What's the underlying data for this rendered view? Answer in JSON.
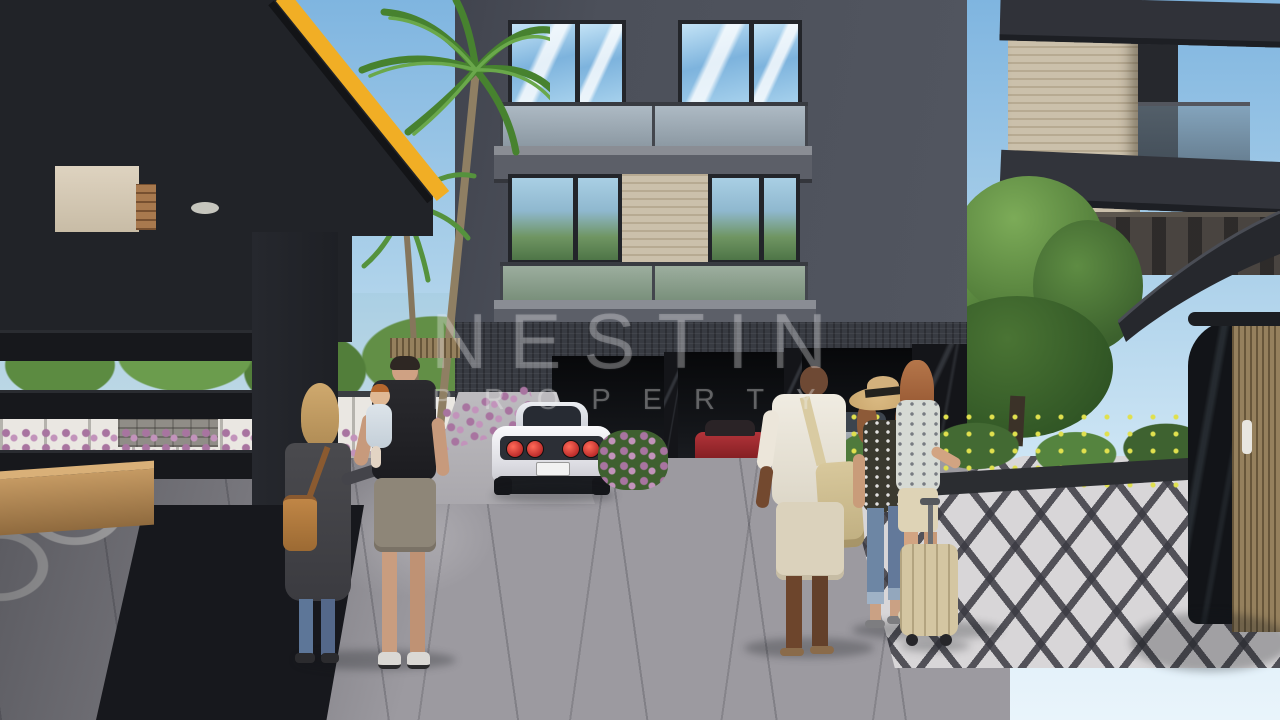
{
  "watermark": {
    "line1": "NESTIN",
    "line2": "PROPERTY"
  },
  "palette": {
    "sky_top": "#7fb5e0",
    "sky_bottom": "#e9f4fb",
    "building_wall": "#4c505a",
    "accent_yellow": "#f1ae25",
    "canopy_dark": "#212328",
    "travertine": "#cbc0ab",
    "garage_stone": "#383b42",
    "pavement_gray": "#a8a6ab",
    "pavement_ring_white": "#e7e5e4",
    "foliage_green": "#5c8b41",
    "flower_purple": "#a874a0",
    "flower_yellow": "#e0e04e",
    "sports_car_white": "#f2f2f5",
    "taillight_red": "#c02020"
  },
  "scene": {
    "setting": "3D architectural exterior render of a modern dark apartment complex entrance with residents",
    "elements": [
      "dark entrance canopy with yellow trim",
      "palm trees",
      "apartment facade with glass balconies and travertine panel",
      "garage level with white sports car and parked cars",
      "family with toddler",
      "three residents walking with a suitcase",
      "ornamental circle-pattern paving",
      "diamond-pattern paving",
      "curved wood-clad kiosk",
      "trees, purple and yellow flowering shrubs",
      "white perimeter fence with globe street lamp"
    ]
  }
}
